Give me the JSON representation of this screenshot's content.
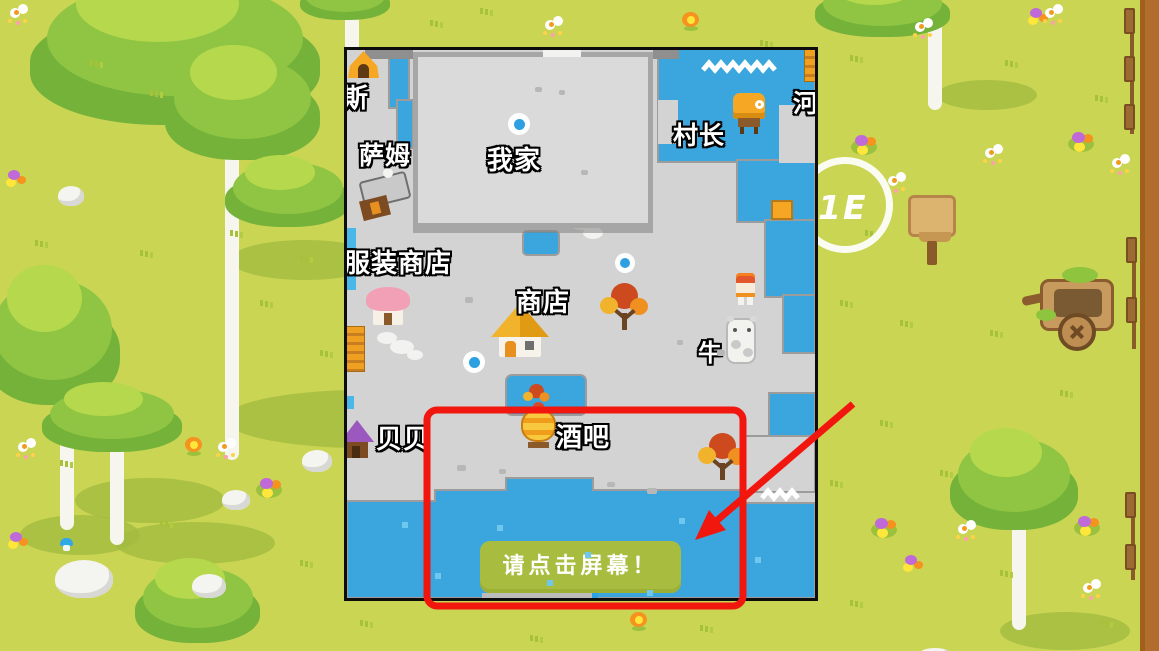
{
  "game": {
    "overlay_button": {
      "label": "请点击屏幕！"
    },
    "minimap": {
      "labels": [
        {
          "key": "si",
          "text": "斯"
        },
        {
          "key": "sam",
          "text": "萨姆"
        },
        {
          "key": "my_home",
          "text": "我家"
        },
        {
          "key": "village_chief",
          "text": "村长"
        },
        {
          "key": "clothing_shop",
          "text": "服装商店"
        },
        {
          "key": "shop",
          "text": "商店"
        },
        {
          "key": "cow",
          "text": "牛"
        },
        {
          "key": "beibei",
          "text": "贝贝"
        },
        {
          "key": "bar",
          "text": "酒吧"
        },
        {
          "key": "river_edge",
          "text": "河"
        }
      ],
      "icons": [
        "tent-icon",
        "village-chief-tent-icon",
        "sam-house-icon",
        "clothing-house-icon",
        "shop-house-icon",
        "beibei-house-icon",
        "bar-icon",
        "autumn-tree-icon",
        "cow-icon",
        "villager-icon",
        "player-marker-icon",
        "bridge-icon"
      ]
    },
    "watermark_text": "1E",
    "annotation_color": "#f2170e",
    "palette": {
      "grass": "#cad553",
      "map_ground": "#d3d3d3",
      "water": "#3aa6dd",
      "button_green": "#a8bd3f"
    }
  }
}
